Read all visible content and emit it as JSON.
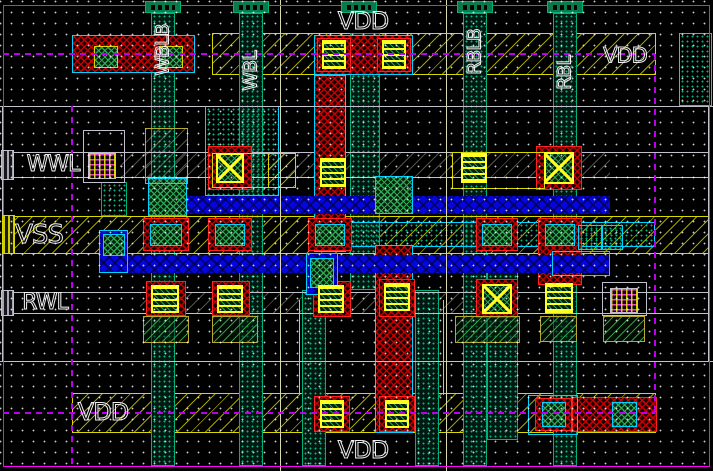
{
  "app": {
    "type": "ic-layout-editor",
    "view": "sram-cell-layout"
  },
  "canvas": {
    "width": 713,
    "height": 471,
    "background": "#000000",
    "grid_dot_color": "#ffffff",
    "grid_spacing_px": 11
  },
  "palette": {
    "bg": "#000000",
    "magenta": "#ff00ff",
    "purple": "#bb00f0",
    "yellow": "#d8d800",
    "byellow": "#ffff20",
    "gray": "#c0c0cc",
    "cream": "#d8d8b0",
    "cyan": "#00d2ff",
    "teal": "#00b07a",
    "red": "#ff2020",
    "olive": "#b8a830",
    "white": "#f0f0f0",
    "blue": "#0505e0"
  },
  "labels": [
    {
      "n": "net-label-vdd-top",
      "text": "VDD",
      "x": 363,
      "y": 21,
      "vert": false,
      "fs": 24
    },
    {
      "n": "net-label-wblb",
      "text": "WBLB",
      "x": 163,
      "y": 50,
      "vert": true,
      "fs": 19
    },
    {
      "n": "net-label-wbl",
      "text": "WBL",
      "x": 251,
      "y": 71,
      "vert": true,
      "fs": 19
    },
    {
      "n": "net-label-rblb",
      "text": "RBLB",
      "x": 475,
      "y": 52,
      "vert": true,
      "fs": 19
    },
    {
      "n": "net-label-rbl",
      "text": "RBL",
      "x": 565,
      "y": 73,
      "vert": true,
      "fs": 19
    },
    {
      "n": "net-label-vdd-right",
      "text": "VDD",
      "x": 625,
      "y": 56,
      "vert": false,
      "fs": 21
    },
    {
      "n": "net-label-wwl",
      "text": "WWL",
      "x": 53,
      "y": 165,
      "vert": false,
      "fs": 22
    },
    {
      "n": "net-label-vss",
      "text": "VSS",
      "x": 39,
      "y": 235,
      "vert": false,
      "fs": 26
    },
    {
      "n": "net-label-rwl",
      "text": "RWL",
      "x": 45,
      "y": 303,
      "vert": false,
      "fs": 22
    },
    {
      "n": "net-label-vdd-bottom-left",
      "text": "VDD",
      "x": 103,
      "y": 412,
      "vert": false,
      "fs": 24
    },
    {
      "n": "net-label-vdd-bottom",
      "text": "VDD",
      "x": 363,
      "y": 450,
      "vert": false,
      "fs": 24
    }
  ],
  "shapes": [
    {
      "n": "vss-rail-hatch",
      "x": 3,
      "y": 217,
      "w": 707,
      "h": 36,
      "p": "ydiag",
      "it": false
    },
    {
      "n": "vdd-rail-top",
      "x": 212,
      "y": 33,
      "w": 444,
      "h": 42,
      "p": "ydiag",
      "b": "yellow"
    },
    {
      "n": "vdd-rail-bottom",
      "x": 72,
      "y": 393,
      "w": 584,
      "h": 40,
      "p": "ydiag",
      "b": "yellow"
    },
    {
      "n": "wwl-row-hatch",
      "x": 120,
      "y": 153,
      "w": 490,
      "h": 24,
      "p": "cream",
      "it": false
    },
    {
      "n": "rwl-row-hatch",
      "x": 140,
      "y": 293,
      "w": 380,
      "h": 20,
      "p": "cream",
      "it": false
    },
    {
      "n": "bitline-col-wblb",
      "x": 151,
      "y": 13,
      "w": 24,
      "h": 453,
      "p": "tdots",
      "b": "teal"
    },
    {
      "n": "bitline-col-wbl",
      "x": 239,
      "y": 13,
      "w": 24,
      "h": 453,
      "p": "tdots",
      "b": "teal"
    },
    {
      "n": "metal-col-center",
      "x": 350,
      "y": 33,
      "w": 30,
      "h": 257,
      "p": "tdots",
      "b": "teal"
    },
    {
      "n": "bitline-col-rblb",
      "x": 463,
      "y": 13,
      "w": 24,
      "h": 453,
      "p": "tdots",
      "b": "teal"
    },
    {
      "n": "bitline-col-rbl",
      "x": 553,
      "y": 13,
      "w": 24,
      "h": 453,
      "p": "tdots",
      "b": "teal"
    },
    {
      "n": "metal-col-bottom-left",
      "x": 302,
      "y": 290,
      "w": 24,
      "h": 176,
      "p": "tdots",
      "b": "teal"
    },
    {
      "n": "metal-col-bottom-right",
      "x": 415,
      "y": 290,
      "w": 24,
      "h": 176,
      "p": "tdots",
      "b": "teal"
    },
    {
      "n": "metal-col-right-wide",
      "x": 487,
      "y": 253,
      "w": 31,
      "h": 187,
      "p": "tdots",
      "b": "teal"
    },
    {
      "n": "poly-block-mid",
      "x": 205,
      "y": 106,
      "w": 74,
      "h": 90,
      "p": "tdotst",
      "b": "cyan"
    },
    {
      "n": "poly-box-left",
      "x": 101,
      "y": 182,
      "w": 26,
      "h": 34,
      "p": "tdotst",
      "b": "teal"
    },
    {
      "n": "nwell-right-block",
      "x": 679,
      "y": 33,
      "w": 33,
      "h": 73,
      "p": "tdotst",
      "b": "cyan"
    },
    {
      "n": "vss-select-band",
      "x": 348,
      "y": 222,
      "w": 307,
      "h": 25,
      "p": "tdotst",
      "b": "cyan"
    },
    {
      "n": "wwl-row-line-top",
      "x": 3,
      "y": 152,
      "w": 707,
      "h": 1,
      "f": "gray",
      "it": false
    },
    {
      "n": "wwl-row-line-bottom",
      "x": 3,
      "y": 177,
      "w": 707,
      "h": 1,
      "f": "gray",
      "it": false
    },
    {
      "n": "rwl-row-line-top",
      "x": 3,
      "y": 292,
      "w": 707,
      "h": 1,
      "f": "gray",
      "it": false
    },
    {
      "n": "rwl-row-line-bottom",
      "x": 3,
      "y": 313,
      "w": 707,
      "h": 1,
      "f": "gray",
      "it": false
    },
    {
      "n": "vss-rail-line-top",
      "x": 3,
      "y": 216,
      "w": 707,
      "h": 1,
      "f": "yellow",
      "it": false
    },
    {
      "n": "vss-rail-line-bottom",
      "x": 3,
      "y": 253,
      "w": 707,
      "h": 1,
      "f": "yellow",
      "it": false
    },
    {
      "n": "pdiff-top-left",
      "x": 72,
      "y": 35,
      "w": 123,
      "h": 38,
      "p": "red",
      "b": "cyan"
    },
    {
      "n": "pdiff-top-center",
      "x": 314,
      "y": 35,
      "w": 99,
      "h": 40,
      "p": "red",
      "b": "cyan"
    },
    {
      "n": "via-frame-top-1",
      "x": 317,
      "y": 38,
      "w": 34,
      "h": 34,
      "b": "red"
    },
    {
      "n": "via-frame-top-2",
      "x": 377,
      "y": 38,
      "w": 34,
      "h": 34,
      "b": "red"
    },
    {
      "n": "pdiff-col-center",
      "x": 314,
      "y": 75,
      "w": 32,
      "h": 177,
      "p": "red",
      "b": "cyan"
    },
    {
      "n": "pdiff-col-bottom",
      "x": 375,
      "y": 245,
      "w": 38,
      "h": 188,
      "p": "red",
      "b": "cyan"
    },
    {
      "n": "ndiff-vss-1",
      "x": 143,
      "y": 218,
      "w": 46,
      "h": 33,
      "p": "red",
      "b": "red"
    },
    {
      "n": "ndiff-vss-2",
      "x": 208,
      "y": 218,
      "w": 44,
      "h": 33,
      "p": "red",
      "b": "red"
    },
    {
      "n": "ndiff-vss-3",
      "x": 308,
      "y": 218,
      "w": 44,
      "h": 33,
      "p": "red",
      "b": "red"
    },
    {
      "n": "ndiff-vss-4",
      "x": 476,
      "y": 218,
      "w": 42,
      "h": 33,
      "p": "red",
      "b": "red"
    },
    {
      "n": "ndiff-vss-5",
      "x": 538,
      "y": 218,
      "w": 44,
      "h": 67,
      "p": "red",
      "b": "red"
    },
    {
      "n": "pdiff-wwl-left",
      "x": 208,
      "y": 146,
      "w": 44,
      "h": 44,
      "p": "red",
      "b": "red"
    },
    {
      "n": "pdiff-wwl-right",
      "x": 536,
      "y": 146,
      "w": 46,
      "h": 44,
      "p": "red",
      "b": "red"
    },
    {
      "n": "ndiff-rwl-1",
      "x": 146,
      "y": 281,
      "w": 40,
      "h": 35,
      "p": "red",
      "b": "red"
    },
    {
      "n": "ndiff-rwl-2",
      "x": 212,
      "y": 281,
      "w": 38,
      "h": 35,
      "p": "red",
      "b": "red"
    },
    {
      "n": "ndiff-rwl-3",
      "x": 313,
      "y": 281,
      "w": 38,
      "h": 36,
      "p": "red",
      "b": "red"
    },
    {
      "n": "ndiff-rwl-4",
      "x": 379,
      "y": 279,
      "w": 36,
      "h": 38,
      "p": "red",
      "b": "red"
    },
    {
      "n": "ndiff-rwl-5",
      "x": 476,
      "y": 279,
      "w": 42,
      "h": 39,
      "p": "red",
      "b": "red"
    },
    {
      "n": "pdiff-vdd-1",
      "x": 314,
      "y": 396,
      "w": 36,
      "h": 36,
      "p": "red",
      "b": "red"
    },
    {
      "n": "pdiff-vdd-2",
      "x": 379,
      "y": 396,
      "w": 36,
      "h": 36,
      "p": "red",
      "b": "red"
    },
    {
      "n": "pdiff-vdd-3",
      "x": 535,
      "y": 398,
      "w": 37,
      "h": 33,
      "p": "red",
      "b": "red"
    },
    {
      "n": "pdiff-vdd-4",
      "x": 572,
      "y": 397,
      "w": 85,
      "h": 35,
      "p": "red",
      "b": "red"
    },
    {
      "n": "metal2-wwl-strap",
      "x": 148,
      "y": 196,
      "w": 462,
      "h": 18,
      "p": "blue"
    },
    {
      "n": "metal2-rwl-strap",
      "x": 100,
      "y": 255,
      "w": 510,
      "h": 18,
      "p": "blue"
    },
    {
      "n": "metal2-left-tab",
      "x": 99,
      "y": 230,
      "w": 29,
      "h": 43,
      "p": "blue",
      "b": "cyan"
    },
    {
      "n": "metal2-center-tab",
      "x": 306,
      "y": 253,
      "w": 32,
      "h": 42,
      "p": "blue",
      "b": "cyan"
    },
    {
      "n": "metal2-right-end",
      "x": 552,
      "y": 251,
      "w": 58,
      "h": 25,
      "b": "cyan"
    },
    {
      "n": "via-gate-left",
      "x": 148,
      "y": 178,
      "w": 39,
      "h": 38,
      "p": "gcross",
      "b": "cyan"
    },
    {
      "n": "via-gate-right",
      "x": 375,
      "y": 176,
      "w": 38,
      "h": 38,
      "p": "gcross",
      "b": "cyan"
    },
    {
      "n": "via-left-tab",
      "x": 103,
      "y": 234,
      "w": 22,
      "h": 22,
      "p": "gcross",
      "b": "cyan"
    },
    {
      "n": "via-center-tab",
      "x": 310,
      "y": 258,
      "w": 24,
      "h": 30,
      "p": "gcross",
      "b": "cyan"
    },
    {
      "n": "poly-contact-box-wwl",
      "x": 83,
      "y": 130,
      "w": 42,
      "h": 53,
      "b": "gray"
    },
    {
      "n": "poly-contact-box-rwl",
      "x": 602,
      "y": 282,
      "w": 45,
      "h": 34,
      "b": "gray"
    },
    {
      "n": "gate-box-wwl-left",
      "x": 212,
      "y": 153,
      "w": 84,
      "h": 35,
      "b": "yellow"
    },
    {
      "n": "gate-hatch-wwl-left",
      "x": 268,
      "y": 153,
      "w": 28,
      "h": 35,
      "p": "ydiag",
      "b": "yellow"
    },
    {
      "n": "gate-box-wwl-right",
      "x": 452,
      "y": 152,
      "w": 93,
      "h": 37,
      "b": "yellow"
    },
    {
      "n": "tan-box-wblb",
      "x": 145,
      "y": 128,
      "w": 43,
      "h": 56,
      "p": "cream",
      "b": "olive"
    },
    {
      "n": "vss-cell-a",
      "x": 578,
      "y": 225,
      "w": 24,
      "h": 25,
      "p": "tdotst",
      "b": "cyan"
    },
    {
      "n": "vss-cell-b",
      "x": 602,
      "y": 225,
      "w": 21,
      "h": 25,
      "p": "tdotst",
      "b": "cyan"
    },
    {
      "n": "cyan-box-vdd-bottom",
      "x": 528,
      "y": 395,
      "w": 50,
      "h": 40,
      "b": "cyan"
    },
    {
      "n": "poly-pad-1",
      "x": 143,
      "y": 316,
      "w": 46,
      "h": 27,
      "p": "ghatch",
      "b": "olive"
    },
    {
      "n": "poly-pad-2",
      "x": 212,
      "y": 316,
      "w": 46,
      "h": 27,
      "p": "ghatch",
      "b": "olive"
    },
    {
      "n": "poly-pad-3",
      "x": 455,
      "y": 316,
      "w": 65,
      "h": 27,
      "p": "ghatch",
      "b": "olive"
    },
    {
      "n": "poly-pad-4",
      "x": 540,
      "y": 316,
      "w": 37,
      "h": 26,
      "p": "ghatch",
      "b": "olive"
    },
    {
      "n": "poly-pad-5",
      "x": 603,
      "y": 316,
      "w": 42,
      "h": 26,
      "p": "ghatch",
      "b": "olive"
    },
    {
      "n": "contact-vdd-top-left-1",
      "x": 94,
      "y": 46,
      "w": 24,
      "h": 22,
      "p": "gcross",
      "b": "yellow"
    },
    {
      "n": "contact-vdd-top-left-2",
      "x": 159,
      "y": 46,
      "w": 24,
      "h": 22,
      "p": "gcross",
      "b": "yellow"
    },
    {
      "n": "via-vdd-top-1",
      "x": 322,
      "y": 40,
      "w": 24,
      "h": 29,
      "p": "stripes",
      "b": "byellow",
      "bw": 2
    },
    {
      "n": "via-vdd-top-2",
      "x": 382,
      "y": 40,
      "w": 24,
      "h": 29,
      "p": "stripes",
      "b": "byellow",
      "bw": 2
    },
    {
      "n": "via-wwl-1",
      "x": 216,
      "y": 153,
      "w": 28,
      "h": 30,
      "p": "xcon",
      "b": "byellow",
      "bw": 2
    },
    {
      "n": "via-wwl-2",
      "x": 320,
      "y": 158,
      "w": 26,
      "h": 29,
      "p": "stripes",
      "b": "byellow",
      "bw": 2
    },
    {
      "n": "via-wwl-3",
      "x": 461,
      "y": 153,
      "w": 26,
      "h": 30,
      "p": "stripes",
      "b": "byellow",
      "bw": 2
    },
    {
      "n": "via-wwl-4",
      "x": 544,
      "y": 152,
      "w": 30,
      "h": 32,
      "p": "xcon",
      "b": "byellow",
      "bw": 2
    },
    {
      "n": "poly-via-wwl",
      "x": 88,
      "y": 153,
      "w": 28,
      "h": 26,
      "p": "grid",
      "b": "gray"
    },
    {
      "n": "poly-via-rwl",
      "x": 610,
      "y": 288,
      "w": 28,
      "h": 25,
      "p": "grid",
      "b": "gray"
    },
    {
      "n": "contact-vss-1",
      "x": 150,
      "y": 224,
      "w": 32,
      "h": 22,
      "p": "gcross",
      "b": "cyan"
    },
    {
      "n": "contact-vss-2",
      "x": 215,
      "y": 224,
      "w": 30,
      "h": 22,
      "p": "gcross",
      "b": "cyan"
    },
    {
      "n": "contact-vss-3",
      "x": 315,
      "y": 224,
      "w": 30,
      "h": 22,
      "p": "gcross",
      "b": "cyan"
    },
    {
      "n": "contact-vss-4",
      "x": 482,
      "y": 224,
      "w": 30,
      "h": 22,
      "p": "gcross",
      "b": "cyan"
    },
    {
      "n": "contact-vss-5",
      "x": 545,
      "y": 224,
      "w": 30,
      "h": 22,
      "p": "gcross",
      "b": "cyan"
    },
    {
      "n": "via-rwl-1",
      "x": 151,
      "y": 285,
      "w": 28,
      "h": 28,
      "p": "stripes",
      "b": "byellow",
      "bw": 2
    },
    {
      "n": "via-rwl-2",
      "x": 217,
      "y": 285,
      "w": 26,
      "h": 28,
      "p": "stripes",
      "b": "byellow",
      "bw": 2
    },
    {
      "n": "via-rwl-3",
      "x": 318,
      "y": 285,
      "w": 26,
      "h": 28,
      "p": "stripes",
      "b": "byellow",
      "bw": 2
    },
    {
      "n": "via-rwl-4",
      "x": 384,
      "y": 283,
      "w": 26,
      "h": 28,
      "p": "stripes",
      "b": "byellow",
      "bw": 2
    },
    {
      "n": "via-rwl-5",
      "x": 482,
      "y": 284,
      "w": 30,
      "h": 30,
      "p": "xcon",
      "b": "byellow",
      "bw": 2
    },
    {
      "n": "via-rwl-6",
      "x": 545,
      "y": 283,
      "w": 28,
      "h": 30,
      "p": "stripes",
      "b": "byellow",
      "bw": 2
    },
    {
      "n": "via-vdd-bottom-1",
      "x": 320,
      "y": 400,
      "w": 24,
      "h": 28,
      "p": "stripes",
      "b": "byellow",
      "bw": 2
    },
    {
      "n": "via-vdd-bottom-2",
      "x": 385,
      "y": 400,
      "w": 24,
      "h": 28,
      "p": "stripes",
      "b": "byellow",
      "bw": 2
    },
    {
      "n": "contact-vdd-bottom-1",
      "x": 542,
      "y": 402,
      "w": 24,
      "h": 25,
      "p": "gcross",
      "b": "cyan"
    },
    {
      "n": "contact-vdd-bottom-2",
      "x": 612,
      "y": 402,
      "w": 25,
      "h": 25,
      "p": "gcross",
      "b": "cyan"
    },
    {
      "n": "cell-boundary-line-h1",
      "x": 0,
      "y": 106,
      "w": 713,
      "h": 1,
      "f": "gray",
      "it": false
    },
    {
      "n": "cell-boundary-line-h2",
      "x": 0,
      "y": 361,
      "w": 713,
      "h": 1,
      "f": "gray",
      "it": false
    },
    {
      "n": "cell-boundary-line-v1",
      "x": 280,
      "y": 0,
      "w": 1,
      "h": 471,
      "f": "cream",
      "it": false
    },
    {
      "n": "cell-boundary-line-v2",
      "x": 446,
      "y": 0,
      "w": 1,
      "h": 471,
      "f": "cream",
      "it": false
    },
    {
      "n": "poly-line-v1",
      "x": 299,
      "y": 300,
      "w": 1,
      "h": 95,
      "f": "yellow",
      "it": false
    },
    {
      "n": "poly-line-v2",
      "x": 443,
      "y": 300,
      "w": 1,
      "h": 95,
      "f": "yellow",
      "it": false
    },
    {
      "n": "cell-edge-left",
      "x": 2,
      "y": 106,
      "w": 2,
      "h": 255,
      "f": "gray",
      "it": false
    },
    {
      "n": "cell-edge-right",
      "x": 708,
      "y": 106,
      "w": 2,
      "h": 255,
      "f": "gray",
      "it": false
    },
    {
      "n": "frame-top",
      "x": 3,
      "y": 5,
      "w": 707,
      "h": 1,
      "f": "magenta",
      "it": false
    },
    {
      "n": "frame-bottom",
      "x": 3,
      "y": 466,
      "w": 707,
      "h": 1,
      "f": "magenta",
      "it": false
    },
    {
      "n": "frame-left",
      "x": 3,
      "y": 5,
      "w": 1,
      "h": 462,
      "f": "magenta",
      "it": false
    },
    {
      "n": "frame-right",
      "x": 709,
      "y": 5,
      "w": 1,
      "h": 462,
      "f": "magenta",
      "it": false
    },
    {
      "n": "guide-dash-h-top",
      "x": 3,
      "y": 53,
      "w": 652,
      "h": 2,
      "p": "dashh",
      "it": false
    },
    {
      "n": "guide-dash-h-bottom",
      "x": 3,
      "y": 412,
      "w": 652,
      "h": 2,
      "p": "dashh",
      "it": false
    },
    {
      "n": "guide-dash-v-left",
      "x": 71,
      "y": 106,
      "w": 2,
      "h": 360,
      "p": "dashv",
      "it": false
    },
    {
      "n": "guide-dash-v-right",
      "x": 654,
      "y": 54,
      "w": 2,
      "h": 359,
      "p": "dashv",
      "it": false
    },
    {
      "n": "port-cap-wblb",
      "x": 145,
      "y": 1,
      "w": 36,
      "h": 12,
      "p": "cap",
      "b": "teal"
    },
    {
      "n": "port-cap-wbl",
      "x": 233,
      "y": 1,
      "w": 36,
      "h": 12,
      "p": "cap",
      "b": "teal"
    },
    {
      "n": "port-cap-vdd",
      "x": 341,
      "y": 1,
      "w": 36,
      "h": 12,
      "p": "cap",
      "b": "teal"
    },
    {
      "n": "port-cap-rblb",
      "x": 457,
      "y": 1,
      "w": 36,
      "h": 12,
      "p": "cap",
      "b": "teal"
    },
    {
      "n": "port-cap-rbl",
      "x": 547,
      "y": 1,
      "w": 36,
      "h": 12,
      "p": "cap",
      "b": "teal"
    },
    {
      "n": "pin-marker-wwl",
      "x": 1,
      "y": 150,
      "w": 13,
      "h": 30,
      "p": "ping",
      "b": "gray"
    },
    {
      "n": "pin-marker-vss",
      "x": 2,
      "y": 215,
      "w": 13,
      "h": 39,
      "p": "piny",
      "b": "yellow"
    },
    {
      "n": "pin-marker-rwl",
      "x": 1,
      "y": 290,
      "w": 13,
      "h": 26,
      "p": "ping",
      "b": "gray"
    }
  ]
}
